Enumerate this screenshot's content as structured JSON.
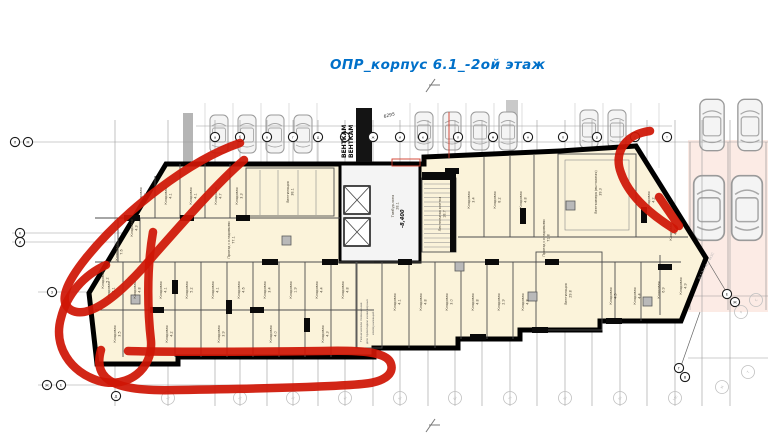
{
  "title": {
    "text": "ОПР_корпус 6.1_-2ой этаж",
    "color": "#0070c9"
  },
  "plan": {
    "room_fill": "#fbf3da",
    "wall_color": "#000000",
    "marker_color": "#cf1505",
    "parking_tint": "#fcebe5",
    "vent_labels": [
      "ВЕНТКАМ",
      "ВЕНТКАМ"
    ],
    "dimension": "6295",
    "elevation": "-8,400",
    "side_note": "2с1 3с1 4с1 4кЗС",
    "tech_room": [
      "Техническое помещение",
      "для прокладки инженерных",
      "коммуникаций"
    ]
  },
  "rooms": [
    {
      "n": "Кладовая",
      "a": "3.8",
      "x": 142,
      "y": 196
    },
    {
      "n": "Кладовая",
      "a": "4.1",
      "x": 167,
      "y": 196
    },
    {
      "n": "Кладовая",
      "a": "4.1",
      "x": 192,
      "y": 196
    },
    {
      "n": "Кладовая",
      "a": "4.7",
      "x": 217,
      "y": 196
    },
    {
      "n": "Кладовая",
      "a": "3.3",
      "x": 238,
      "y": 196
    },
    {
      "n": "Кладовая",
      "a": "4.3",
      "x": 133,
      "y": 228
    },
    {
      "n": "Кладовая",
      "a": "7.6",
      "x": 118,
      "y": 252
    },
    {
      "n": "Кладовая",
      "a": "5.2",
      "x": 104,
      "y": 280
    },
    {
      "n": "Вентиляция",
      "a": "38.1",
      "x": 289,
      "y": 192
    },
    {
      "n": "Проезд с кладовыми",
      "a": "77.1",
      "x": 230,
      "y": 240
    },
    {
      "n": "Проезд с кладовыми",
      "a": "71.8",
      "x": 545,
      "y": 238
    },
    {
      "n": "Кладовая",
      "a": "3.1",
      "x": 110,
      "y": 290
    },
    {
      "n": "Кладовая",
      "a": "4.8",
      "x": 136,
      "y": 290
    },
    {
      "n": "Кладовая",
      "a": "4.1",
      "x": 162,
      "y": 290
    },
    {
      "n": "Кладовая",
      "a": "5.2",
      "x": 188,
      "y": 290
    },
    {
      "n": "Кладовая",
      "a": "4.1",
      "x": 214,
      "y": 290
    },
    {
      "n": "Кладовая",
      "a": "4.6",
      "x": 240,
      "y": 290
    },
    {
      "n": "Кладовая",
      "a": "3.4",
      "x": 266,
      "y": 290
    },
    {
      "n": "Кладовая",
      "a": "1.9",
      "x": 292,
      "y": 290
    },
    {
      "n": "Кладовая",
      "a": "4.4",
      "x": 318,
      "y": 290
    },
    {
      "n": "Кладовая",
      "a": "4.8",
      "x": 344,
      "y": 290
    },
    {
      "n": "Кладовая",
      "a": "3.5",
      "x": 116,
      "y": 334
    },
    {
      "n": "Кладовая",
      "a": "4.2",
      "x": 168,
      "y": 334
    },
    {
      "n": "Кладовая",
      "a": "3.9",
      "x": 220,
      "y": 334
    },
    {
      "n": "Кладовая",
      "a": "4.0",
      "x": 272,
      "y": 334
    },
    {
      "n": "Кладовая",
      "a": "4.3",
      "x": 324,
      "y": 334
    },
    {
      "n": "Кладовая",
      "a": "3.4",
      "x": 470,
      "y": 200
    },
    {
      "n": "Кладовая",
      "a": "8.2",
      "x": 496,
      "y": 200
    },
    {
      "n": "Кладовая",
      "a": "4.8",
      "x": 522,
      "y": 200
    },
    {
      "n": "Тамбур-зона",
      "a": "28.1",
      "x": 394,
      "y": 206
    },
    {
      "n": "Лестничная клетка",
      "a": "18.7",
      "x": 441,
      "y": 214
    },
    {
      "n": "Венткамера (вытяжная)",
      "a": "39.3",
      "x": 597,
      "y": 192
    },
    {
      "n": "Кладовая",
      "a": "4.2",
      "x": 650,
      "y": 200
    },
    {
      "n": "Кладовая",
      "a": "4.7",
      "x": 672,
      "y": 232
    },
    {
      "n": "Кладовая",
      "a": "4.1",
      "x": 396,
      "y": 302
    },
    {
      "n": "Кладовая",
      "a": "4.8",
      "x": 422,
      "y": 302
    },
    {
      "n": "Кладовая",
      "a": "3.0",
      "x": 448,
      "y": 302
    },
    {
      "n": "Кладовая",
      "a": "4.8",
      "x": 474,
      "y": 302
    },
    {
      "n": "Кладовая",
      "a": "2.9",
      "x": 500,
      "y": 302
    },
    {
      "n": "Кладовая",
      "a": "4.8",
      "x": 524,
      "y": 302
    },
    {
      "n": "Вентиляция",
      "a": "29.8",
      "x": 567,
      "y": 294
    },
    {
      "n": "Кладовая",
      "a": "4.5",
      "x": 612,
      "y": 296
    },
    {
      "n": "Кладовая",
      "a": "4.4",
      "x": 636,
      "y": 296
    },
    {
      "n": "Кладовая",
      "a": "6.9",
      "x": 660,
      "y": 290
    },
    {
      "n": "Кладовая",
      "a": "4.9",
      "x": 682,
      "y": 286
    }
  ],
  "grid": {
    "hlines": [
      {
        "y": 126,
        "x1": 196,
        "x2": 672
      },
      {
        "y": 142,
        "x1": 12,
        "x2": 768
      },
      {
        "y": 233,
        "x1": 12,
        "x2": 546
      },
      {
        "y": 242,
        "x1": 12,
        "x2": 546
      },
      {
        "y": 292,
        "x1": 38,
        "x2": 92
      },
      {
        "y": 385,
        "x1": 38,
        "x2": 312
      },
      {
        "y": 296,
        "x1": 688,
        "x2": 768
      },
      {
        "y": 358,
        "x1": 688,
        "x2": 768
      }
    ],
    "vlines": [
      115,
      168,
      215,
      240,
      267,
      293,
      318,
      345,
      373,
      400,
      428,
      455,
      482,
      510,
      537,
      565,
      592,
      620,
      647,
      675,
      702,
      730
    ],
    "top_axes": [
      {
        "x": 215,
        "label": "а"
      },
      {
        "x": 240,
        "label": "б"
      },
      {
        "x": 267,
        "label": "в"
      },
      {
        "x": 293,
        "label": "г"
      },
      {
        "x": 318,
        "label": "д"
      },
      {
        "x": 345,
        "label": "е"
      },
      {
        "x": 373,
        "label": "ж"
      },
      {
        "x": 400,
        "label": "и"
      },
      {
        "x": 423,
        "label": "к"
      },
      {
        "x": 458,
        "label": "л"
      },
      {
        "x": 493,
        "label": "м"
      },
      {
        "x": 528,
        "label": "н"
      },
      {
        "x": 563,
        "label": "п"
      },
      {
        "x": 597,
        "label": "р"
      },
      {
        "x": 635,
        "label": "с"
      },
      {
        "x": 667,
        "label": "т"
      }
    ],
    "dark_axes": [
      {
        "x": 15,
        "y": 142,
        "label": "Л"
      },
      {
        "x": 28,
        "y": 142,
        "label": "М"
      },
      {
        "x": 20,
        "y": 233,
        "label": "К"
      },
      {
        "x": 20,
        "y": 242,
        "label": "И"
      },
      {
        "x": 52,
        "y": 292,
        "label": "З"
      },
      {
        "x": 47,
        "y": 385,
        "label": "Ж"
      },
      {
        "x": 61,
        "y": 385,
        "label": "Е"
      },
      {
        "x": 116,
        "y": 396,
        "label": "Д"
      },
      {
        "x": 727,
        "y": 294,
        "label": "Е"
      },
      {
        "x": 735,
        "y": 302,
        "label": "Ж"
      },
      {
        "x": 679,
        "y": 368,
        "label": "Г"
      },
      {
        "x": 685,
        "y": 377,
        "label": "В"
      }
    ],
    "bottom_axes": [
      {
        "x": 168,
        "label": "1с"
      },
      {
        "x": 240,
        "label": "2с"
      },
      {
        "x": 293,
        "label": "3с"
      },
      {
        "x": 345,
        "label": "4с"
      },
      {
        "x": 400,
        "label": "5с"
      },
      {
        "x": 455,
        "label": "6с"
      },
      {
        "x": 510,
        "label": "7с"
      },
      {
        "x": 565,
        "label": "8с"
      },
      {
        "x": 620,
        "label": "9с"
      },
      {
        "x": 675,
        "label": "10с"
      }
    ],
    "right_axes": [
      {
        "x": 741,
        "y": 312,
        "label": "Р"
      },
      {
        "x": 756,
        "y": 300,
        "label": "С"
      },
      {
        "x": 748,
        "y": 372,
        "label": "Т"
      },
      {
        "x": 722,
        "y": 387,
        "label": "М"
      }
    ]
  },
  "cars": [
    {
      "x": 219,
      "y": 134
    },
    {
      "x": 247,
      "y": 134
    },
    {
      "x": 275,
      "y": 134
    },
    {
      "x": 303,
      "y": 134
    },
    {
      "x": 424,
      "y": 131
    },
    {
      "x": 452,
      "y": 131
    },
    {
      "x": 480,
      "y": 131
    },
    {
      "x": 508,
      "y": 131
    },
    {
      "x": 589,
      "y": 129
    },
    {
      "x": 617,
      "y": 129
    },
    {
      "x": 712,
      "y": 125,
      "s": 1.35
    },
    {
      "x": 750,
      "y": 125,
      "s": 1.35
    },
    {
      "x": 709,
      "y": 208,
      "s": 1.7
    },
    {
      "x": 747,
      "y": 208,
      "s": 1.7
    }
  ]
}
